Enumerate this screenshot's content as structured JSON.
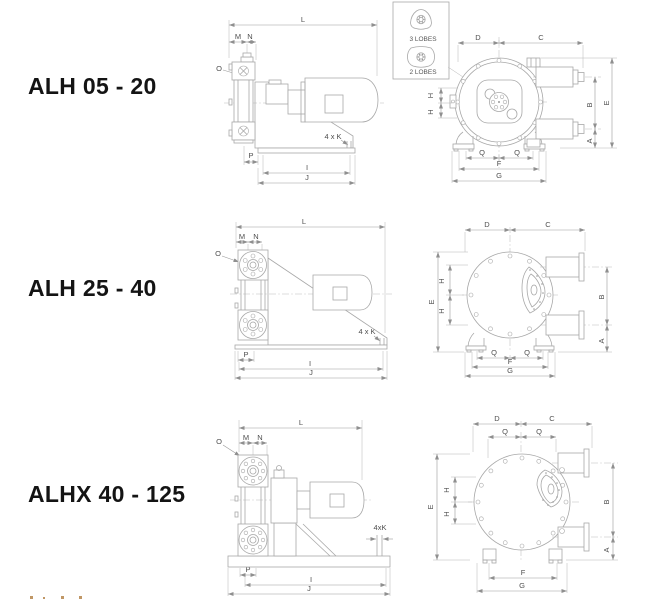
{
  "page": {
    "background": "#ffffff"
  },
  "colors": {
    "drawing_line": "#a8a8a8",
    "dim_line": "#9a9a9a",
    "dim_text": "#4f4f4f",
    "title_text": "#141414",
    "cutoff_fragment": "#b5854b"
  },
  "inset": {
    "label_3_lobes": "3 LOBES",
    "label_2_lobes": "2 LOBES"
  },
  "models": [
    {
      "name": "ALH 05 - 20",
      "side_view": {
        "dims": {
          "L": "L",
          "M": "M",
          "N": "N",
          "O": "O",
          "K": "4 x K",
          "P": "P",
          "I": "I",
          "J": "J"
        }
      },
      "front_view": {
        "dims": {
          "D": "D",
          "C": "C",
          "H1": "H",
          "H2": "H",
          "B": "B",
          "E": "E",
          "A": "A",
          "Q1": "Q",
          "Q2": "Q",
          "F": "F",
          "G": "G"
        }
      }
    },
    {
      "name": "ALH 25 - 40",
      "side_view": {
        "dims": {
          "L": "L",
          "M": "M",
          "N": "N",
          "O": "O",
          "K": "4 x K",
          "P": "P",
          "I": "I",
          "J": "J"
        }
      },
      "front_view": {
        "dims": {
          "D": "D",
          "C": "C",
          "H1": "H",
          "H2": "H",
          "B": "B",
          "E": "E",
          "A": "A",
          "Q1": "Q",
          "Q2": "Q",
          "F": "F",
          "G": "G"
        }
      }
    },
    {
      "name": "ALHX 40 - 125",
      "side_view": {
        "dims": {
          "L": "L",
          "M": "M",
          "N": "N",
          "O": "O",
          "K": "4xK",
          "P": "P",
          "I": "I",
          "J": "J"
        }
      },
      "front_view": {
        "dims": {
          "D": "D",
          "C": "C",
          "H1": "H",
          "H2": "H",
          "B": "B",
          "E": "E",
          "A": "A",
          "Q1": "Q",
          "Q2": "Q",
          "F": "F",
          "G": "G"
        }
      }
    }
  ]
}
